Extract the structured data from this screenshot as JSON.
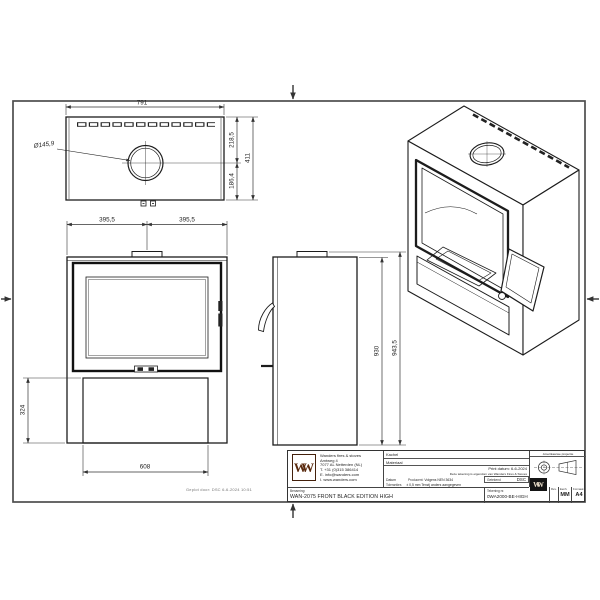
{
  "dims": {
    "top_width": "791",
    "hole_dia": "Ø145,9",
    "top_upper": "218,5",
    "top_lower": "186,4",
    "top_total": "411",
    "front_half_left": "395,5",
    "front_half_right": "395,5",
    "base_height": "324",
    "base_width": "608",
    "side_body": "930",
    "side_total": "943,5"
  },
  "title_block": {
    "logo_text": "WW",
    "company": {
      "name": "Wanders fires & stoves",
      "address1": "Amtweg 4",
      "address2": "7077 AL Netterden (NL)",
      "phone": "T. +31 (0)315 386414",
      "email": "E. info@wanders.com",
      "website": "I. www.wanders.com"
    },
    "labels": {
      "kachel": "Kachel",
      "materiaal": "Materiaal",
      "datum": "Datum",
      "producent": "Producent:",
      "toleranties": "Toleranties",
      "getekend": "Getekend",
      "benaming": "Benaming:",
      "tekening_nr": "Tekening nr.",
      "projection": "Amerikaanse projectie",
      "rev": "Rev.",
      "eenheid": "Eenh.",
      "formaat": "Formaat"
    },
    "values": {
      "print_datum": "Print datum: 6-6-2024",
      "ownership": "Deze tekening is eigendom van Wanders Fires & Stoves",
      "getekend": "DSC",
      "producent": "Volgens NEN 3634",
      "toleranties": "± 0,5 mm Tenzij anders aangegeven",
      "benaming": "WAN-2075 FRONT BLACK EDITION HIGH",
      "tekening_nr": "0WA2000-BE-HIGH",
      "eenheid": "MM",
      "formaat": "A4"
    }
  },
  "plot_stamp": "Geplot door: DSC 6-6-2024 10:51"
}
